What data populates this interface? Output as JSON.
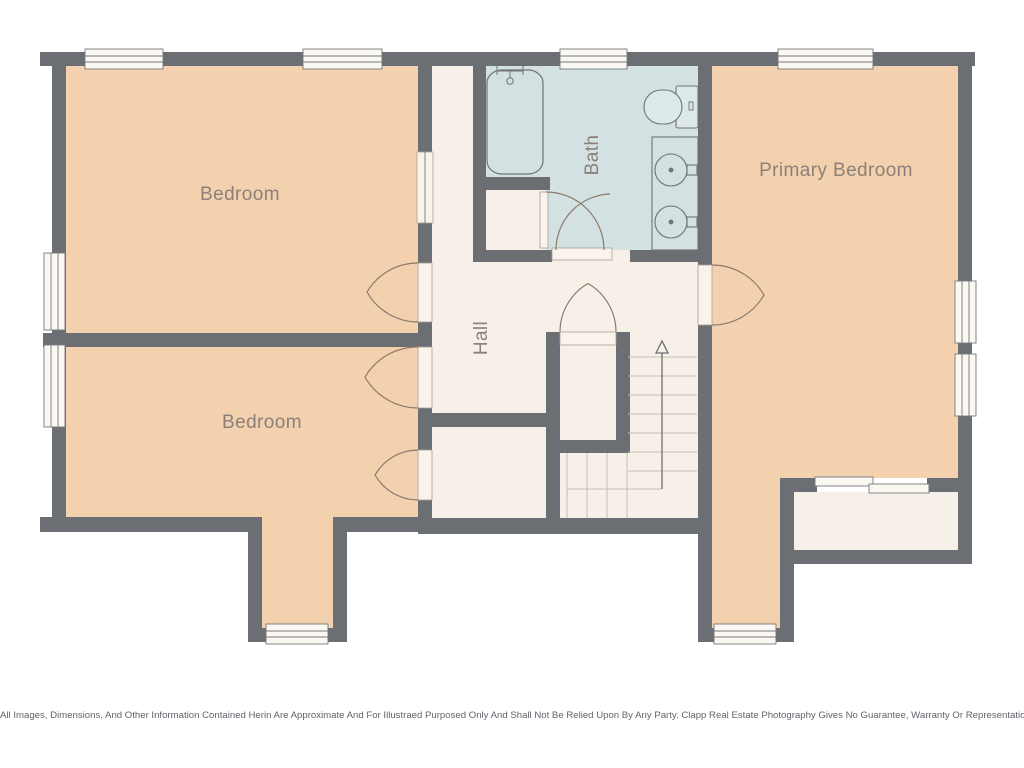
{
  "rooms": [
    {
      "id": "bedroom-top-left",
      "label": "Bedroom"
    },
    {
      "id": "bedroom-bottom-left",
      "label": "Bedroom"
    },
    {
      "id": "bath",
      "label": "Bath"
    },
    {
      "id": "hall",
      "label": "Hall"
    },
    {
      "id": "primary-bedroom",
      "label": "Primary Bedroom"
    }
  ],
  "fixtures": [
    "bathtub-icon",
    "shower-icon",
    "toilet-icon",
    "vanity-icon",
    "sink-icon",
    "sink-icon",
    "staircase-icon",
    "stairs-up-arrow-icon"
  ],
  "colors": {
    "wall": "#6b6f74",
    "bedroom_fill": "#f3d0ae",
    "bath_fill": "#d4e1e2",
    "hall_fill": "#f7f0e8",
    "window_fill": "#fbf8f1",
    "door_arc": "#8a7b6c",
    "label_text": "#8b8179",
    "stair_line": "#c4beb5",
    "disclaimer_text": "#5f646a",
    "background": "#ffffff"
  },
  "disclaimer": "All Images, Dimensions, And Other Information Contained Herin Are Approximate And For Illustraed Purposed Only And Shall Not Be Relied Upon By Any Party. Clapp Real Estate Photography Gives No Guarantee, Warranty Or Representation As To The Accuracy Of This Information."
}
